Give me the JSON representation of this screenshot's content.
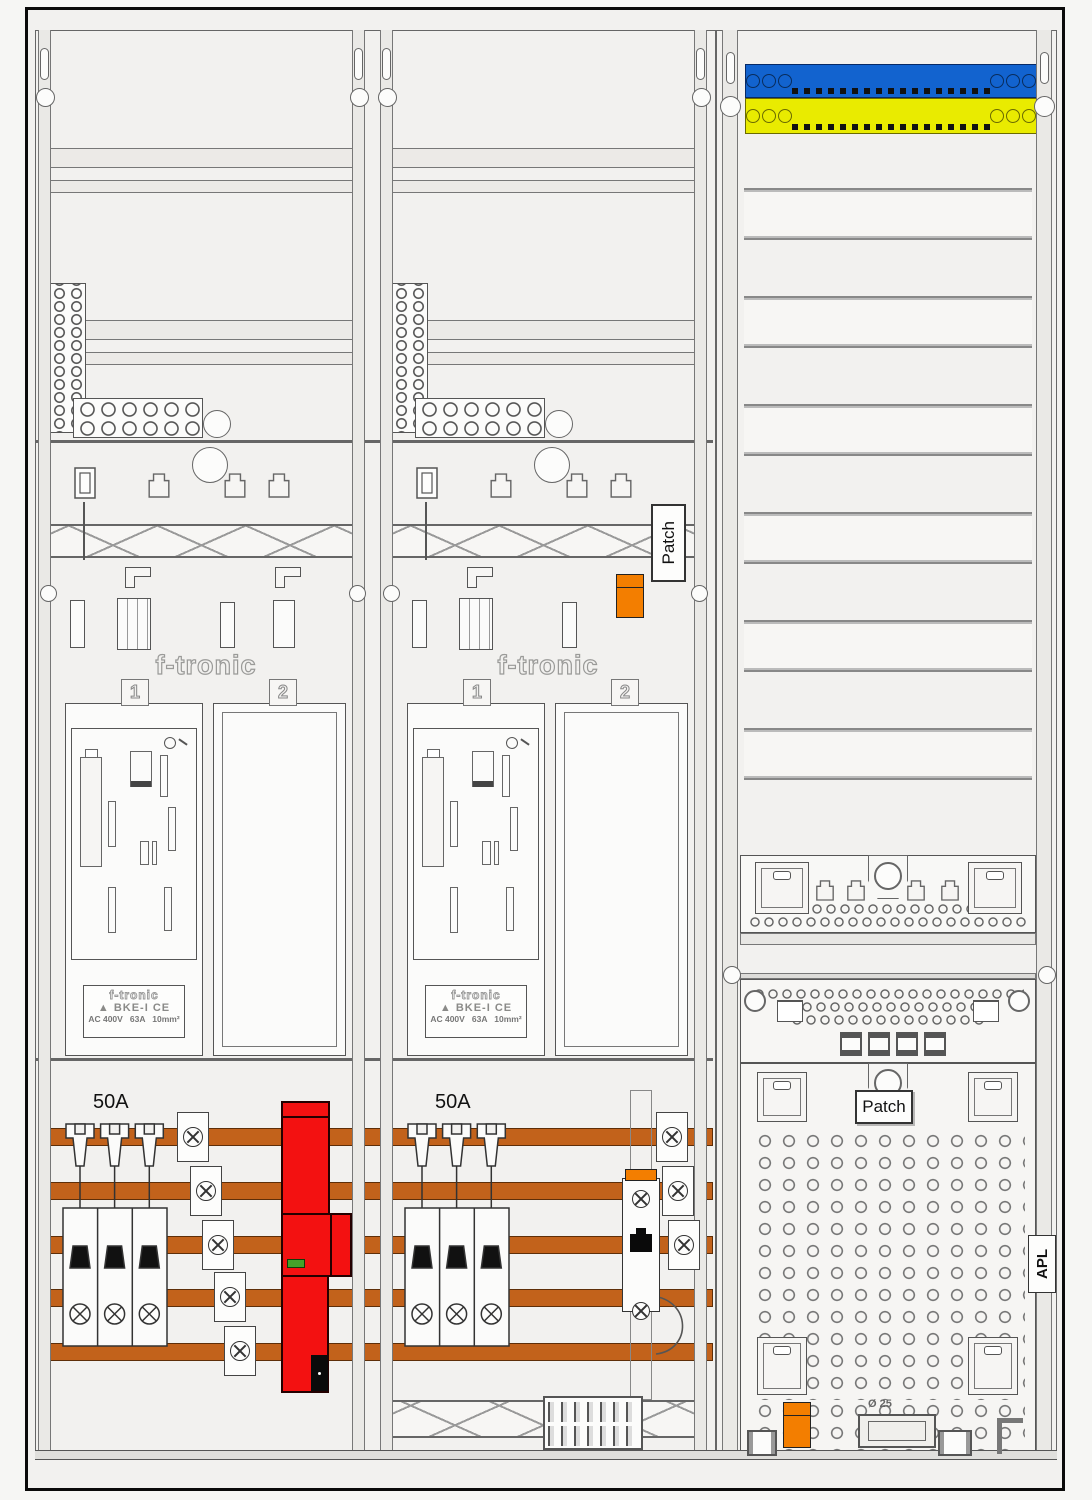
{
  "labels": {
    "patch_vertical": "Patch",
    "patch_panel": "Patch",
    "apl": "APL",
    "knockout_diameter": "Ø 25"
  },
  "meter_fields": {
    "brand_watermark": "f-tronic",
    "slot1": "1",
    "slot2": "2",
    "breaker_rating": "50A",
    "type_label": {
      "brand": "f-tronic",
      "logo_glyph": "▲",
      "model": "BKE-I",
      "ce_mark": "CE",
      "rating": "AC 400V   63A   10mm²"
    }
  },
  "colors": {
    "neutral_busbar_blue": "#1263cf",
    "pe_busbar_yellow": "#e9eb00",
    "phase_busbar_copper": "#c2621b",
    "sls_switch_red": "#f31111",
    "connector_orange": "#f37e00",
    "indicator_green": "#43a32a"
  }
}
